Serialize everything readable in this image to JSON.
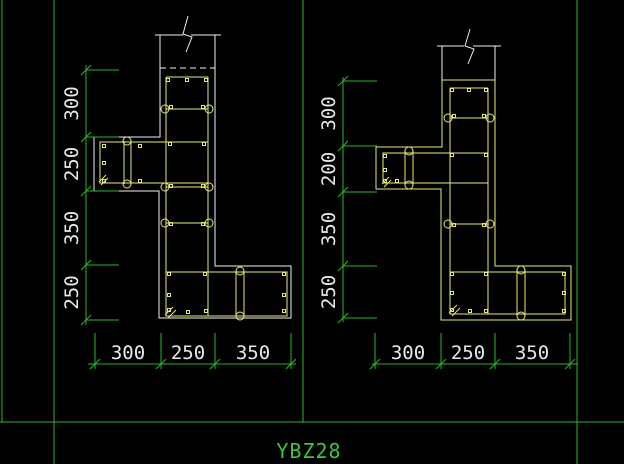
{
  "sheet": {
    "title": "YBZ28"
  },
  "colors": {
    "background": "#000000",
    "frame_green": "#2cb42c",
    "section_outline_white": "#f0f0f0",
    "rebar_yellow": "#e8e87a",
    "dimension_text": "#e9e9e9",
    "title_text": "#3cc63c"
  },
  "figures": [
    {
      "name": "left-section",
      "left_dims": [
        "300",
        "250",
        "350",
        "250"
      ],
      "bottom_dims": [
        "300",
        "250",
        "350"
      ]
    },
    {
      "name": "right-section",
      "left_dims": [
        "300",
        "200",
        "350",
        "250"
      ],
      "bottom_dims": [
        "300",
        "250",
        "350"
      ]
    }
  ]
}
